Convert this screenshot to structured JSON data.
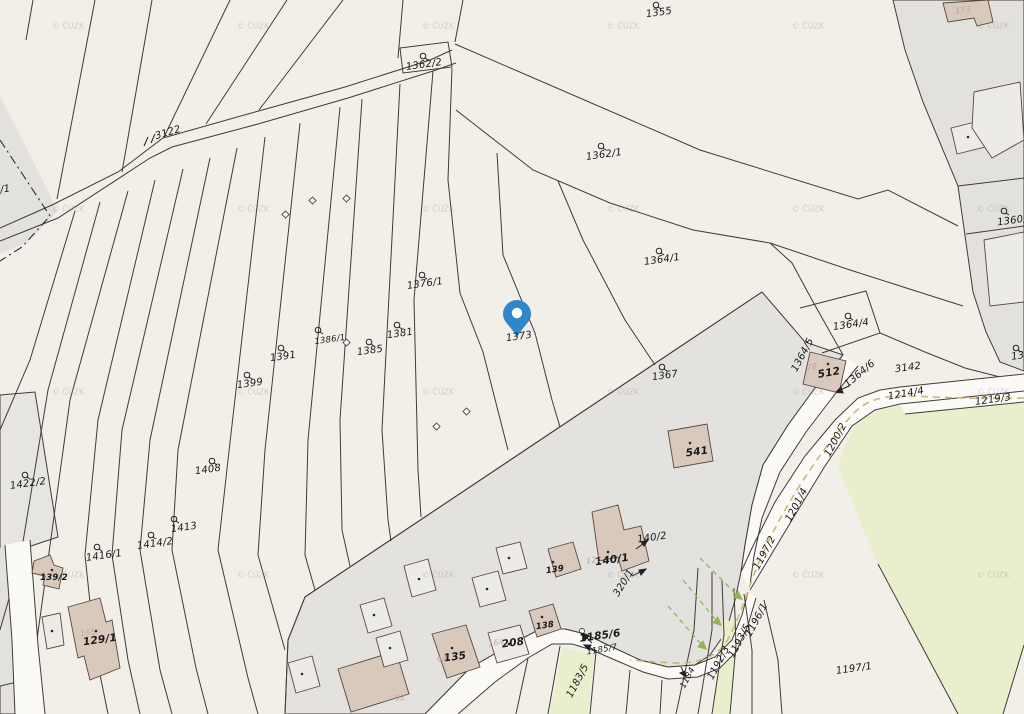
{
  "map_title": "Cadastral parcel map",
  "watermark": {
    "text": "© ČÚZK"
  },
  "colors": {
    "bg": "#f2efe9",
    "gray": "#e3e1dd",
    "gray2": "#e7e5e1",
    "green": "#e9efcd",
    "road": "#fbfaf7",
    "line": "#3f3b36",
    "building": "#d9c8bc",
    "building-light": "#edebe6",
    "bstroke": "#55493f",
    "pin": "#2f86c8",
    "olive-dash": "#c9b878",
    "green-dash": "#96b159"
  },
  "icons": {
    "pin": "location-pin"
  },
  "labels": {
    "l3122": "3122",
    "l1362_2": "1362/2",
    "l1355": "1355",
    "l1362_1": "1362/1",
    "l173": "173",
    "l1360": "1360/",
    "l136": "136",
    "l1364_1": "1364/1",
    "l1376_1": "1376/1",
    "l1381": "1381",
    "l1386_1": "1386/1",
    "l1385": "1385",
    "l1391": "1391",
    "l1399": "1399",
    "l1373": "1373",
    "l1367": "1367",
    "l541": "541",
    "l1364_4": "1364/4",
    "l1364_5": "1364/5",
    "l512": "512",
    "l1364_6": "1364/6",
    "l3142": "3142",
    "l1214_4": "1214/4",
    "l1219_3": "1219/3",
    "l1200_2": "1200/2",
    "l1201_4": "1201/4",
    "l1197_2": "1197/2",
    "l1196_1": "1196/1",
    "l1193_5": "1193/5",
    "l1192_3": "1192/3",
    "l1197_1": "1197/1",
    "l1184": "1184",
    "l1185_6": "1185/6",
    "l1185_7": "1185/7",
    "l1183_5": "1183/5",
    "l1422_2": "1422/2",
    "l1408": "1408",
    "l1413": "1413",
    "l1414_2": "1414/2",
    "l1416_1": "1416/1",
    "l139_2": "139/2",
    "l129_1": "129/1",
    "l135": "135",
    "l208": "208",
    "l138": "138",
    "l139": "139",
    "l140_1": "140/1",
    "l140_2": "140/2",
    "l320_1": "320/1",
    "l5_1": "5/1"
  },
  "faint_labels": {
    "f94": "94",
    "f164": "164",
    "f123": "123",
    "f78": "78",
    "f155": "155",
    "f92": "92"
  }
}
